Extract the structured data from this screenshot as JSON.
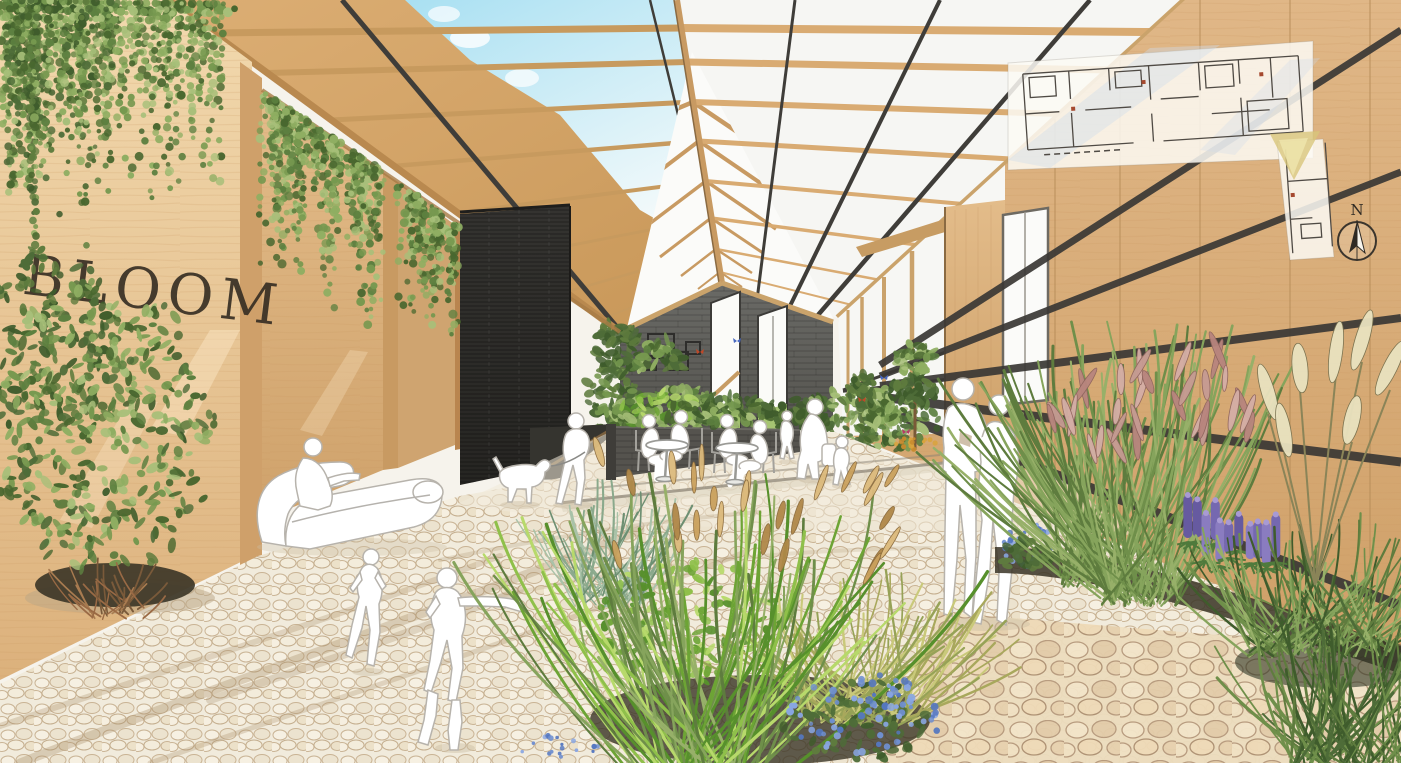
{
  "signage": {
    "wall_text": "BLOOM"
  },
  "plan_inset": {
    "north_label": "N",
    "kind": "floor-plan-overlay"
  },
  "palette": {
    "wood_light": "#f2d9ae",
    "wood": "#d8a96e",
    "wood_dark": "#b8854c",
    "wood_right_top": "#e0b787",
    "wood_right_bottom": "#cfa068",
    "steel": "#3a3835",
    "gable": "#5e5d58",
    "monolith_top": "#343330",
    "monolith_bottom": "#262522",
    "sky_top": "#a9e0f2",
    "sky_bottom": "#f4fafb",
    "glass": "#f7f7f4",
    "pebble": "#f1ebdc",
    "pebble_line": "#c9b394",
    "pebble_warm": "#e7d3b4",
    "soil": "#3a3426",
    "greens": [
      "#5d8040",
      "#76984f",
      "#8fae62",
      "#49672f",
      "#a7bf79"
    ],
    "greens_dark": [
      "#3f5c2c",
      "#4e6c38",
      "#5f7c3e"
    ],
    "greens_bright": [
      "#8fc04a",
      "#6da435",
      "#b7d96b",
      "#57902c"
    ],
    "grass_greens": [
      "#6f8f4a",
      "#86a45c",
      "#97b069",
      "#5e7c3e"
    ],
    "glaucous": [
      "#8aa98c",
      "#a9c2a8",
      "#6d8f72"
    ],
    "sedge": [
      "#c9c97a",
      "#a8a85c",
      "#96a257"
    ],
    "plume_pink": [
      "#c69b93",
      "#b8857e",
      "#d4aea6"
    ],
    "plume_tan": [
      "#caa15d",
      "#dcba7c",
      "#b08849"
    ],
    "pampas": "#e9e2bf",
    "lupine": [
      "#8a7cc0",
      "#7568b0",
      "#665aa0"
    ],
    "blue_flowers": [
      "#6f8fd0",
      "#89a6e2",
      "#5577c0"
    ],
    "silhouette": "#ffffff",
    "silhouette_line": "#b7b3ac",
    "ink": "#342c22",
    "plan_line": "#4f4a44",
    "plan_dot": "#a5492f",
    "cone": "#d8c67a"
  }
}
